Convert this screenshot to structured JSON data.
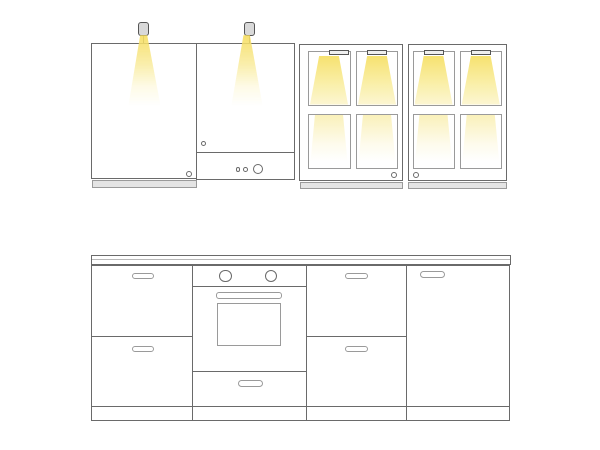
{
  "colors": {
    "outline": "#6a6a6a",
    "outline_light": "#9a9a9a",
    "strip_fill": "#e4e4e4",
    "fixture_fill": "#d9d9d9",
    "fixture_outline": "#555555",
    "bg": "#ffffff",
    "beam_bright": "#f6de6e",
    "beam_mid": "#f9edaa",
    "beam_faint": "#fdf8dc"
  },
  "scene": {
    "type": "kitchen-cabinet-lighting-line-drawing",
    "upper_row": {
      "spotlight_fixtures": 2,
      "plain_door_cabinets": 2,
      "door_knobs": 2,
      "control_panel_knobs": 3,
      "glass_door_cabinets": 2,
      "glass_panes_per_cabinet": 4,
      "pane_light_bars_per_cabinet": 2,
      "glass_cabinet_knobs": 2,
      "under_cabinet_strips": 3
    },
    "base_row": {
      "countertop": 1,
      "drawer_cabinets": 2,
      "oven_unit": {
        "knobs": 2,
        "handle_bar": 1,
        "window": 1,
        "bottom_drawer": 1
      },
      "tall_door_cabinet": 1,
      "pill_handles": 6,
      "plinth_sections": 4
    }
  }
}
